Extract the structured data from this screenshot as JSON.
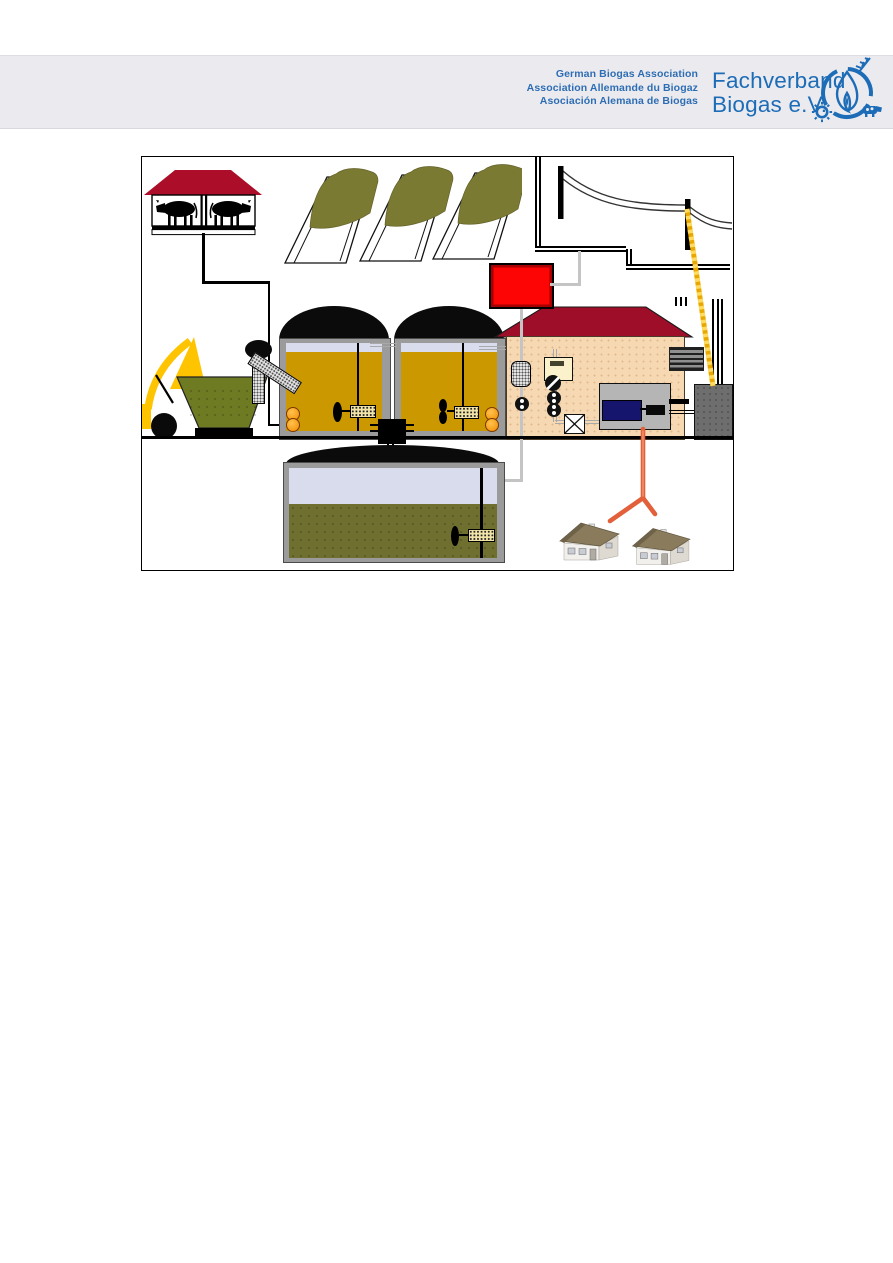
{
  "header": {
    "band_color": "#EBEBEF",
    "text_color": "#2E6DB4",
    "brand_color": "#1D6CB7",
    "association_lines": [
      "German Biogas Association",
      "Association Allemande du Biogaz",
      "Asociación Alemana de Biogas"
    ],
    "brand_line1": "Fachverband",
    "brand_line2": "Biogas e.V.",
    "logo_elements": [
      "circle-arcs",
      "wheat-ear",
      "flame",
      "gear",
      "cow"
    ]
  },
  "diagram": {
    "type": "biogas-plant-schematic",
    "colors": {
      "fermenter_substrate": "#CC9800",
      "tank_wall": "#9B9B9B",
      "gas_dome": "#0B0B0B",
      "gas_headspace": "#D9DCEC",
      "digestate": "#6F7030",
      "silage": "#7B7A33",
      "hopper": "#6F7B22",
      "building_wall": "#F6D8B2",
      "roof_red": "#9E0E28",
      "flare_red": "#FE0505",
      "heat_pipe": "#E2603A",
      "power_cable": "#F5B800",
      "gas_pipe_gray": "#C4C4C4",
      "loader_yellow": "#FFC400",
      "inlet_orange": "#FFA126",
      "chp_engine_navy": "#15156E"
    },
    "components": [
      "cow-barn",
      "manure-pipe",
      "silage-clamps",
      "wheel-loader",
      "feed-hopper",
      "screw-feeder",
      "fermenter-1",
      "fermenter-2",
      "agitators",
      "central-pump",
      "gas-flare",
      "gas-pipes",
      "plant-building",
      "gas-treatment-train",
      "chp-unit",
      "emergency-cooler",
      "exhaust-stack",
      "transformer",
      "power-line-inset",
      "power-cable",
      "digestate-storage-tank",
      "heat-pipe",
      "heated-houses"
    ]
  }
}
